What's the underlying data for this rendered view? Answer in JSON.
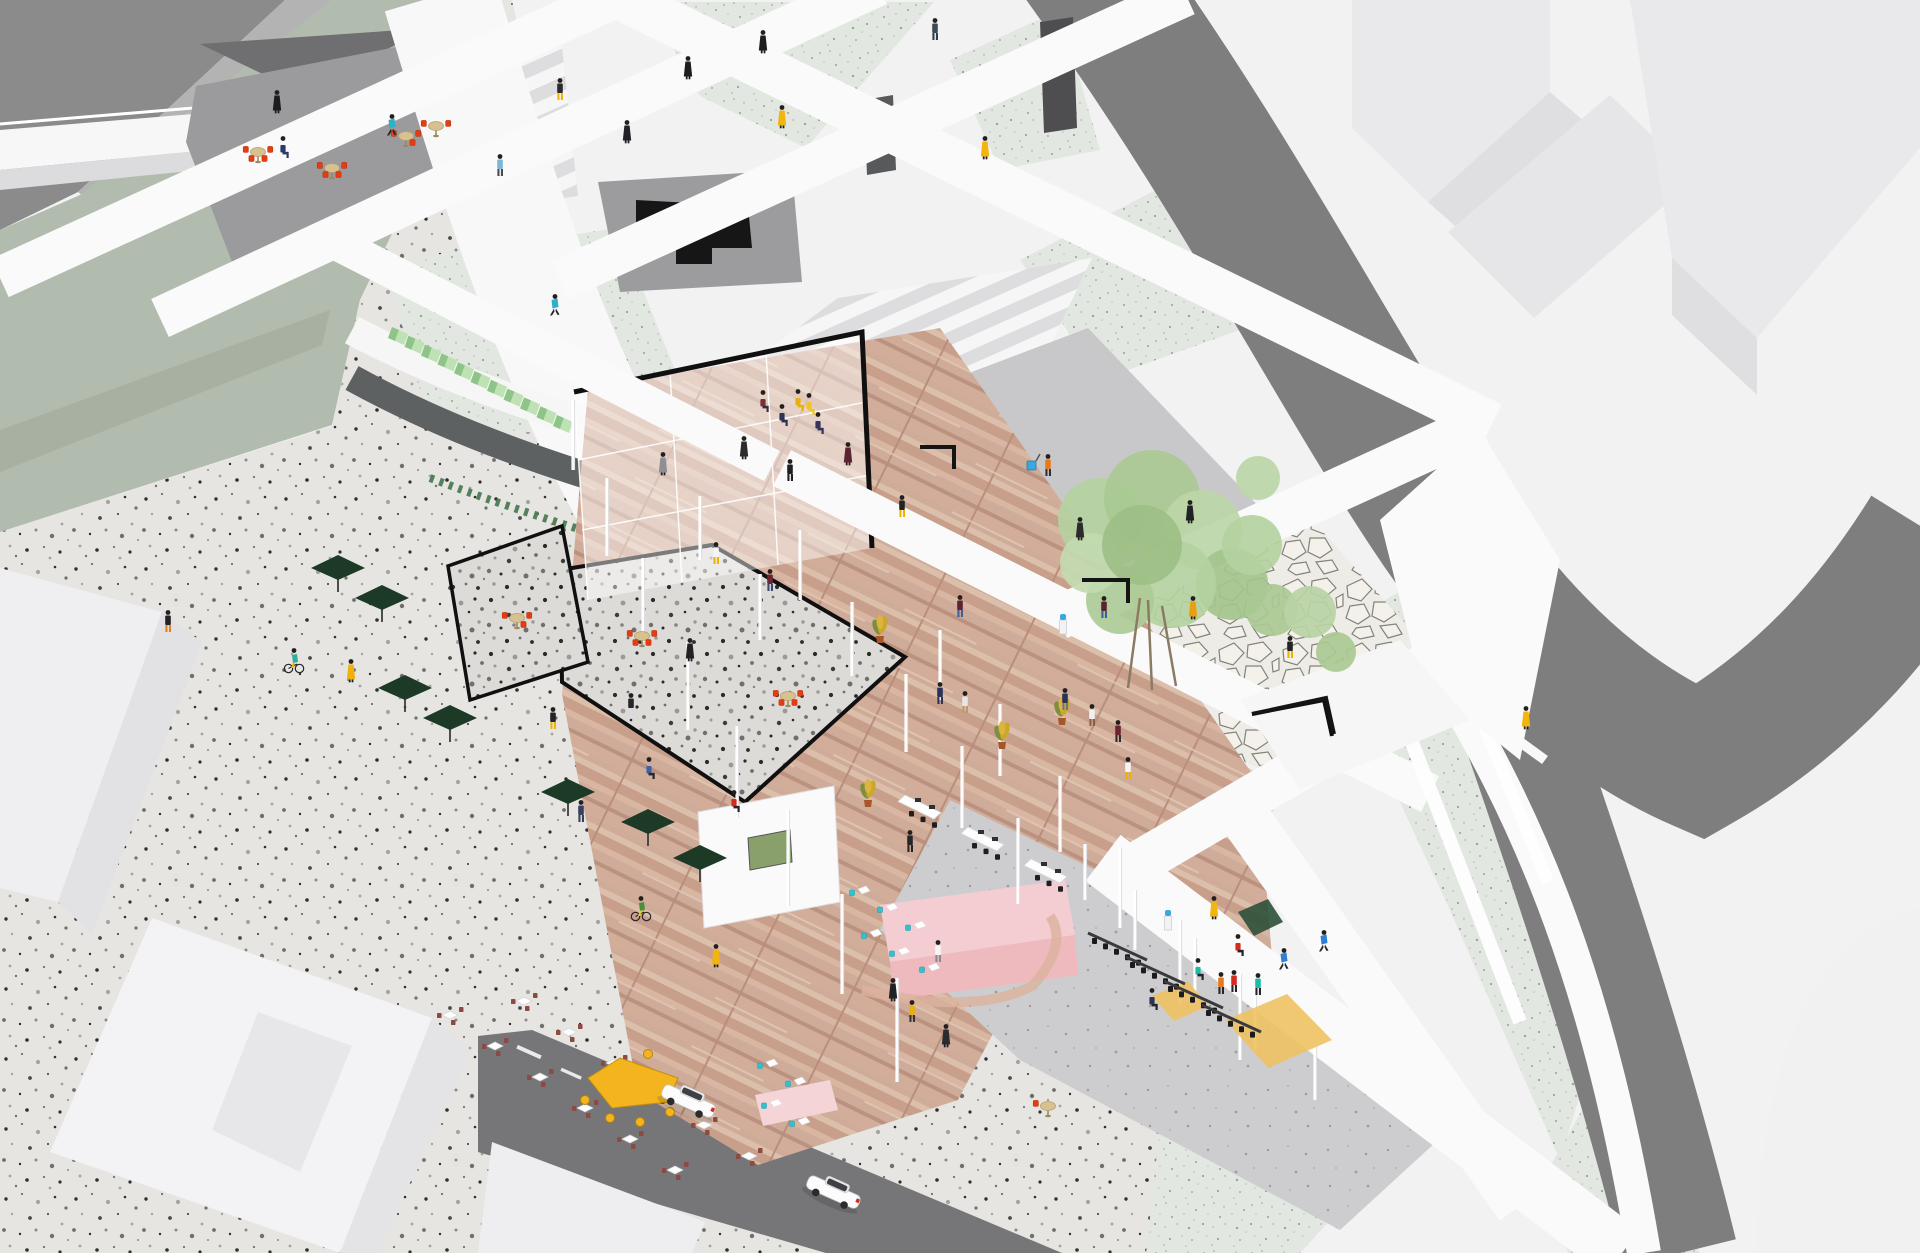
{
  "title": "Axonometric architectural cutaway illustration of a public building complex",
  "canvas": {
    "width": 1920,
    "height": 1253
  },
  "palette": {
    "bg": "#f2f2f3",
    "roadDark": "#7e7e7e",
    "roadBottom": "#767678",
    "corner": "#8b8b8b",
    "sliver": "#b3b3b3",
    "sage": "#b2bcae",
    "sageDark": "#a4ae9f",
    "beam": "#fafafb",
    "buildTop": "#e9e9eb",
    "buildSide": "#dfdfe2",
    "slab": "#e6e6e8",
    "plazaGray": "#c8c8ca",
    "cafeGray": "#9b9b9d",
    "darkTri": "#6f6f71",
    "frame": "#101010",
    "bandDark": "#5e6162",
    "seatGreen": "#8fc489",
    "seatGreenTop": "#bfe2b4",
    "chairRed": "#e63c12",
    "tableTan": "#d8c190",
    "parasolGreen": "#1c3a26",
    "counterPink": "#f3cdd2",
    "counterPinkDark": "#eebabe",
    "chairTeal": "#2cc4d2",
    "chairMaroon": "#8c4a42",
    "treeGreen": "#b4d1a0",
    "blob": "#f1f1f2",
    "woodBase": "#cfab99",
    "yellowTable": "#f3b41e"
  },
  "scene": {
    "people": [
      [
        277,
        112,
        "#1d1d1f",
        "#1d1d1f",
        "dress"
      ],
      [
        392,
        136,
        "#2fb0c9",
        "#26262a",
        "run"
      ],
      [
        688,
        78,
        "#1e1e20",
        "#1e1e20",
        "dress"
      ],
      [
        763,
        52,
        "#1e1e20",
        "#1e1e20",
        "dress"
      ],
      [
        935,
        40,
        "#3d4a54",
        "#313c46",
        "walk"
      ],
      [
        782,
        127,
        "#f2b40f",
        "#f2b40f",
        "dress"
      ],
      [
        985,
        158,
        "#f2b40f",
        "#f2b40f",
        "dress"
      ],
      [
        560,
        100,
        "#2a2a2e",
        "#f0b400",
        "walk"
      ],
      [
        627,
        142,
        "#222226",
        "#222226",
        "dress"
      ],
      [
        500,
        176,
        "#7db5d6",
        "#4a4a50",
        "walk"
      ],
      [
        555,
        316,
        "#2fb0c9",
        "#26262a",
        "run"
      ],
      [
        744,
        458,
        "#2b2b2e",
        "#2b2b2e",
        "dress"
      ],
      [
        663,
        474,
        "#8f8f95",
        "#8f8f95",
        "dress"
      ],
      [
        763,
        412,
        "#7c2f38",
        "#32323a",
        "sit"
      ],
      [
        782,
        426,
        "#2d3356",
        "#2d3356",
        "sit"
      ],
      [
        798,
        411,
        "#e8b00f",
        "#e8b00f",
        "sit"
      ],
      [
        809,
        415,
        "#f0c52a",
        "#f0c52a",
        "sit"
      ],
      [
        818,
        434,
        "#33355c",
        "#33355c",
        "sit"
      ],
      [
        790,
        481,
        "#1f1f22",
        "#1f1f22",
        "walk"
      ],
      [
        283,
        158,
        "#2b3a66",
        "#2b3a66",
        "sit"
      ],
      [
        902,
        517,
        "#232325",
        "#f0b400",
        "walk"
      ],
      [
        848,
        464,
        "#5c2330",
        "#5c2330",
        "dress"
      ],
      [
        1048,
        476,
        "#e87a1a",
        "#30303a",
        "walk"
      ],
      [
        1080,
        539,
        "#2b2b2e",
        "#2b2b2e",
        "dress"
      ],
      [
        1190,
        522,
        "#222226",
        "#222226",
        "dress"
      ],
      [
        960,
        617,
        "#5c2330",
        "#3a5d9e",
        "walk"
      ],
      [
        1193,
        618,
        "#e8a00f",
        "#e8a00f",
        "dress"
      ],
      [
        1104,
        618,
        "#5c2330",
        "#3a5d9e",
        "walk"
      ],
      [
        1290,
        658,
        "#232325",
        "#f0b400",
        "walk"
      ],
      [
        1526,
        728,
        "#f2b40f",
        "#f2b40f",
        "dress"
      ],
      [
        168,
        632,
        "#232325",
        "#e0821f",
        "walk"
      ],
      [
        294,
        670,
        "#2fae9e",
        "#f0b400",
        "bike"
      ],
      [
        351,
        681,
        "#f0b10e",
        "#f0b10e",
        "dress"
      ],
      [
        553,
        729,
        "#242428",
        "#e8b70f",
        "walk"
      ],
      [
        581,
        822,
        "#37405c",
        "#37405c",
        "walk"
      ],
      [
        631,
        715,
        "#26262a",
        "#d9d9df",
        "walk"
      ],
      [
        641,
        918,
        "#4a8f3a",
        "#f3c520",
        "bike"
      ],
      [
        716,
        966,
        "#f2b40f",
        "#f2b40f",
        "dress"
      ],
      [
        716,
        564,
        "#f5f5f7",
        "#f0b400",
        "walk"
      ],
      [
        770,
        591,
        "#6b2430",
        "#3a4a6e",
        "walk"
      ],
      [
        690,
        660,
        "#222226",
        "#222226",
        "dress"
      ],
      [
        1065,
        710,
        "#2d3356",
        "#6b7684",
        "walk"
      ],
      [
        1092,
        726,
        "#f0f0f2",
        "#8a6248",
        "walk"
      ],
      [
        1118,
        742,
        "#6b2430",
        "#2e2e34",
        "walk"
      ],
      [
        940,
        704,
        "#2d3356",
        "#2d3356",
        "walk"
      ],
      [
        965,
        713,
        "#e6e6ea",
        "#b89a6e",
        "walk"
      ],
      [
        1128,
        779,
        "#f5f5f7",
        "#e8b00f",
        "walk"
      ],
      [
        1238,
        956,
        "#d42b20",
        "#232328",
        "sit"
      ],
      [
        1198,
        980,
        "#1fb9a8",
        "#232328",
        "sit"
      ],
      [
        1152,
        1010,
        "#2d3356",
        "#232328",
        "sit"
      ],
      [
        893,
        1000,
        "#222226",
        "#222226",
        "dress"
      ],
      [
        938,
        962,
        "#f5f5f7",
        "#8a8a90",
        "walk"
      ],
      [
        912,
        1022,
        "#e8b00f",
        "#33333a",
        "walk"
      ],
      [
        946,
        1046,
        "#2b2b30",
        "#2b2b30",
        "dress"
      ],
      [
        1214,
        918,
        "#f2b40f",
        "#f2b40f",
        "dress"
      ],
      [
        1284,
        970,
        "#2f7fd4",
        "#26262a",
        "run"
      ],
      [
        1324,
        952,
        "#2f7fd4",
        "#26262a",
        "run"
      ],
      [
        1234,
        992,
        "#d42b20",
        "#26262a",
        "walk"
      ],
      [
        1221,
        994,
        "#e87a1a",
        "#26262a",
        "walk"
      ],
      [
        1258,
        995,
        "#1fb9a8",
        "#26262a",
        "walk"
      ],
      [
        910,
        852,
        "#26262a",
        "#26262a",
        "walk"
      ],
      [
        649,
        779,
        "#3a65a8",
        "#26262a",
        "sit"
      ],
      [
        734,
        812,
        "#d42b20",
        "#26262a",
        "sit"
      ]
    ],
    "red_table_sets": [
      [
        258,
        152,
        4
      ],
      [
        332,
        168,
        4
      ],
      [
        406,
        136,
        3
      ],
      [
        436,
        126,
        2
      ],
      [
        517,
        618,
        3
      ],
      [
        642,
        636,
        4
      ],
      [
        788,
        696,
        4
      ],
      [
        1048,
        1106,
        1
      ]
    ],
    "teal_chairs": [
      [
        852,
        895
      ],
      [
        880,
        912
      ],
      [
        908,
        930
      ],
      [
        864,
        938
      ],
      [
        892,
        956
      ],
      [
        922,
        972
      ],
      [
        760,
        1068
      ],
      [
        788,
        1086
      ],
      [
        764,
        1108
      ],
      [
        792,
        1126
      ]
    ],
    "outdoor_tables": [
      [
        450,
        1016
      ],
      [
        495,
        1047
      ],
      [
        540,
        1078
      ],
      [
        585,
        1109
      ],
      [
        630,
        1140
      ],
      [
        675,
        1171
      ],
      [
        524,
        1002
      ],
      [
        569,
        1033
      ],
      [
        614,
        1064
      ],
      [
        659,
        1095
      ],
      [
        704,
        1126
      ],
      [
        749,
        1157
      ]
    ],
    "parasols": [
      [
        405,
        688
      ],
      [
        450,
        718
      ],
      [
        568,
        792
      ],
      [
        648,
        822
      ],
      [
        700,
        858
      ],
      [
        338,
        568
      ],
      [
        382,
        598
      ]
    ],
    "plants": [
      [
        868,
        800
      ],
      [
        1002,
        742
      ],
      [
        1062,
        718
      ],
      [
        880,
        636
      ]
    ],
    "water_coolers": [
      [
        1063,
        634
      ],
      [
        1168,
        930
      ]
    ],
    "desks": [
      [
        905,
        795
      ],
      [
        968,
        827
      ],
      [
        1031,
        859
      ]
    ],
    "office_chair_rows": [
      [
        1092,
        938,
        5
      ],
      [
        1130,
        962,
        5
      ],
      [
        1168,
        986,
        5
      ],
      [
        1206,
        1010,
        5
      ]
    ],
    "columns": [
      [
        573,
        470,
        70
      ],
      [
        607,
        556,
        78
      ],
      [
        643,
        642,
        84
      ],
      [
        688,
        730,
        88
      ],
      [
        737,
        818,
        92
      ],
      [
        788,
        906,
        96
      ],
      [
        842,
        994,
        100
      ],
      [
        897,
        1082,
        104
      ],
      [
        800,
        600,
        70
      ],
      [
        852,
        676,
        74
      ],
      [
        906,
        752,
        78
      ],
      [
        962,
        828,
        82
      ],
      [
        1018,
        904,
        86
      ],
      [
        700,
        560,
        64
      ],
      [
        760,
        640,
        66
      ],
      [
        940,
        700,
        70
      ],
      [
        1000,
        776,
        72
      ],
      [
        1060,
        852,
        76
      ],
      [
        1120,
        928,
        80
      ],
      [
        1180,
        1004,
        84
      ],
      [
        1240,
        1060,
        86
      ],
      [
        1135,
        950,
        60
      ],
      [
        1195,
        1000,
        62
      ],
      [
        1255,
        1050,
        64
      ],
      [
        1315,
        1100,
        66
      ],
      [
        1085,
        900,
        56
      ]
    ],
    "cars": [
      [
        688,
        1102
      ],
      [
        833,
        1193
      ]
    ],
    "tree_canopy": [
      [
        1100,
        520,
        42,
        "#b4d1a0"
      ],
      [
        1152,
        498,
        48,
        "#a9c993"
      ],
      [
        1202,
        530,
        40,
        "#bcd6a8"
      ],
      [
        1232,
        584,
        36,
        "#a3c48b"
      ],
      [
        1172,
        584,
        44,
        "#b4d1a0"
      ],
      [
        1120,
        600,
        34,
        "#aecb97"
      ],
      [
        1090,
        563,
        30,
        "#c2dab0"
      ],
      [
        1252,
        545,
        30,
        "#b4d1a0"
      ],
      [
        1272,
        610,
        26,
        "#a9c993"
      ],
      [
        1310,
        612,
        26,
        "#b8d3a4"
      ],
      [
        1336,
        652,
        20,
        "#a9c993"
      ],
      [
        1258,
        478,
        22,
        "#bcd6a8"
      ],
      [
        1142,
        545,
        40,
        "#9dbf85"
      ]
    ],
    "tree_trunks": [
      [
        1128,
        688,
        1140,
        598
      ],
      [
        1152,
        690,
        1148,
        600
      ],
      [
        1176,
        686,
        1162,
        606
      ]
    ],
    "benches": [
      "920,447 954,447 954,469",
      "1082,580 1128,580 1128,603",
      "1252,714 1326,698 1334,734"
    ],
    "green_seats": {
      "x": 388,
      "y": 338,
      "dx": 16.5,
      "dy": 8.8,
      "count": 11
    },
    "play_mats": [
      [
        "1225,1020 1287,994 1332,1040 1268,1068",
        "#eec262"
      ],
      [
        "1152,996 1188,981 1208,1006 1174,1021",
        "#eec262"
      ],
      [
        "1238,912 1268,899 1283,922 1254,936",
        "#2e5039"
      ]
    ],
    "beams": [
      [
        600,
        -12,
        1492,
        424,
        44
      ],
      [
        330,
        240,
        772,
        466,
        34
      ],
      [
        782,
        468,
        1430,
        794,
        40
      ],
      [
        642,
        -15,
        0,
        278,
        42
      ],
      [
        878,
        -15,
        160,
        318,
        42
      ],
      [
        1186,
        -5,
        560,
        280,
        42
      ],
      [
        1480,
        425,
        1058,
        618,
        44
      ],
      [
        1520,
        640,
        1140,
        862,
        44
      ],
      [
        1103,
        858,
        1622,
        1253,
        58
      ],
      [
        1245,
        818,
        1520,
        1206,
        50
      ]
    ],
    "beam_curves": [
      [
        "M 1420,642 C 1538,822 1602,1002 1644,1253",
        34
      ]
    ],
    "mini_strips": [
      [
        1380,
        660,
        1520,
        1022,
        14
      ],
      [
        1432,
        600,
        1548,
        882,
        12
      ],
      [
        1448,
        690,
        1545,
        760,
        10
      ]
    ],
    "canteen_table": {
      "x": 630,
      "y": 1086
    },
    "carts": [
      [
        1032,
        470
      ]
    ]
  }
}
